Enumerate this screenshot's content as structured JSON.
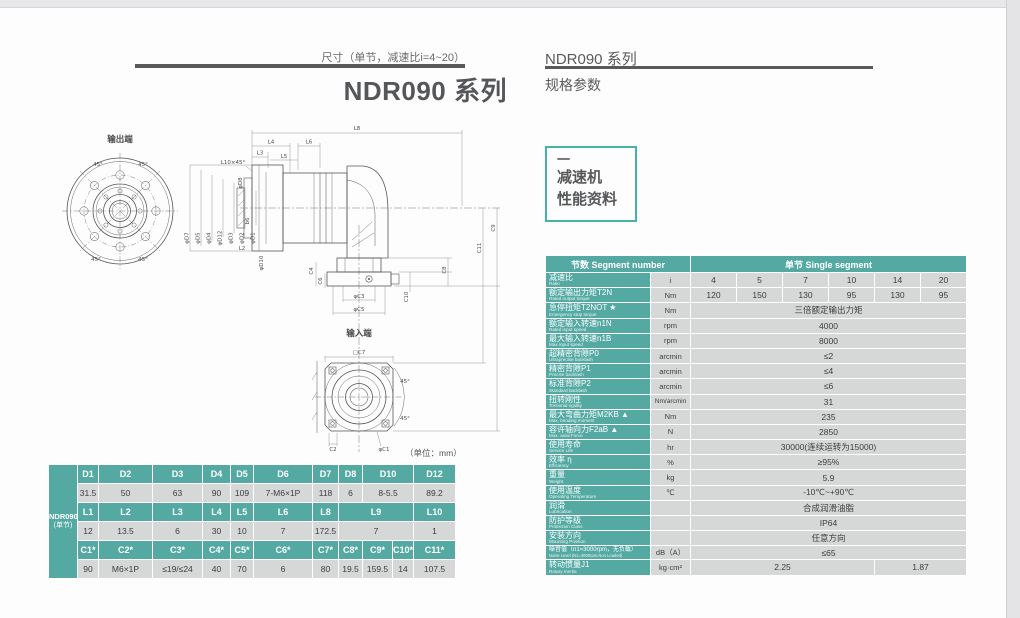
{
  "left": {
    "subtitle": "尺寸（单节，减速比i=4~20）",
    "title": "NDR090 系列",
    "unit_note": "（单位：mm）"
  },
  "right": {
    "series": "NDR090 系列",
    "section": "规格参数",
    "tab": {
      "dash": "一",
      "line1": "减速机",
      "line2": "性能资料"
    }
  },
  "drawing": {
    "output_end": "输出端",
    "input_end": "输入端",
    "angle": "45°",
    "top": [
      "L8",
      "L4",
      "L6",
      "L3",
      "L5",
      "L10×45°"
    ],
    "left_dims": [
      "φD7",
      "φD5",
      "φD4",
      "φD12",
      "φD3",
      "φD2",
      "φD1",
      "φD8",
      "b6"
    ],
    "mid_dims": [
      "L2",
      "φD10",
      "C4",
      "C6"
    ],
    "right_dims": [
      "C9",
      "C11",
      "C8",
      "C10"
    ],
    "input_dims": [
      "φC3",
      "φC5"
    ],
    "square": [
      "□C7",
      "C2",
      "φC1"
    ]
  },
  "dim": {
    "model": "NDR090",
    "model_sub": "(单节)",
    "d_headers": [
      "D1",
      "D2",
      "D3",
      "D4",
      "D5",
      "D6",
      "D7",
      "D8",
      "D10",
      "D12"
    ],
    "d_values": [
      "31.5",
      "50",
      "63",
      "90",
      "109",
      "7-M6×1P",
      "118",
      "6",
      "8-5.5",
      "89.2"
    ],
    "l_headers": [
      "L1",
      "L2",
      "L3",
      "L4",
      "L5",
      "L6",
      "L8",
      "L9",
      "L10"
    ],
    "l_values": [
      "12",
      "13.5",
      "6",
      "30",
      "10",
      "7",
      "172.5",
      "7",
      "1"
    ],
    "c_headers": [
      "C1*",
      "C2*",
      "C3*",
      "C4*",
      "C5*",
      "C6*",
      "C7*",
      "C8*",
      "C9*",
      "C10*",
      "C11*"
    ],
    "c_values": [
      "90",
      "M6×1P",
      "≤19/≤24",
      "40",
      "70",
      "6",
      "80",
      "19.5",
      "159.5",
      "14",
      "107.5"
    ]
  },
  "spec": {
    "header_left": "节数 Segment number",
    "header_right": "单节 Single segment",
    "rows": [
      {
        "cn": "减速比",
        "en": "Ratio",
        "unit": "i",
        "values": [
          "4",
          "5",
          "7",
          "10",
          "14",
          "20"
        ]
      },
      {
        "cn": "额定输出力矩T2N",
        "en": "Rated output torque",
        "unit": "Nm",
        "values": [
          "120",
          "150",
          "130",
          "95",
          "130",
          "95"
        ]
      },
      {
        "cn": "急停扭矩T2NOT ★",
        "en": "Emergency stop torque",
        "unit": "Nm",
        "value": "三倍额定输出力矩"
      },
      {
        "cn": "额定输入转速n1N",
        "en": "Rated input speed",
        "unit": "rpm",
        "value": "4000"
      },
      {
        "cn": "最大输入转速n1B",
        "en": "Max input speed",
        "unit": "rpm",
        "value": "8000"
      },
      {
        "cn": "超精密背隙P0",
        "en": "Ultraprecise backlash",
        "unit": "arcmin",
        "value": "≤2"
      },
      {
        "cn": "精密背隙P1",
        "en": "Precise backlash",
        "unit": "arcmin",
        "value": "≤4"
      },
      {
        "cn": "标准背隙P2",
        "en": "Standard backlash",
        "unit": "arcmin",
        "value": "≤6"
      },
      {
        "cn": "扭转刚性",
        "en": "Torsional rigidity",
        "unit": "Nm/arcmin",
        "value": "31"
      },
      {
        "cn": "最大弯曲力矩M2KB ▲",
        "en": "Max. bending moment",
        "unit": "Nm",
        "value": "235"
      },
      {
        "cn": "容许轴向力F2aB ▲",
        "en": "Max. axial Force",
        "unit": "N",
        "value": "2850"
      },
      {
        "cn": "使用寿命",
        "en": "Service Life",
        "unit": "hr",
        "value": "30000(连续运转为15000)"
      },
      {
        "cn": "效率 η",
        "en": "Efficiency",
        "unit": "%",
        "value": "≥95%"
      },
      {
        "cn": "重量",
        "en": "Weight",
        "unit": "kg",
        "value": "5.9"
      },
      {
        "cn": "使用温度",
        "en": "Operating Temperature",
        "unit": "℃",
        "value": "-10℃~+90℃"
      },
      {
        "cn": "润滑",
        "en": "Lubrication",
        "unit": "",
        "value": "合成润滑油脂"
      },
      {
        "cn": "防护等级",
        "en": "Protection Class",
        "unit": "",
        "value": "IP64"
      },
      {
        "cn": "安装方向",
        "en": "Mounting Position",
        "unit": "",
        "value": "任意方向"
      },
      {
        "cn": "噪音值（n1=3000rpm，无负载）",
        "en": "Noise Level (N1=3000rpm,Non Loaded)",
        "unit": "dB（A）",
        "value": "≤65"
      },
      {
        "cn": "转动惯量J1",
        "en": "Rotary Inertia",
        "unit": "kg·cm²",
        "values": [
          "2.25",
          "1.87"
        ]
      }
    ]
  }
}
